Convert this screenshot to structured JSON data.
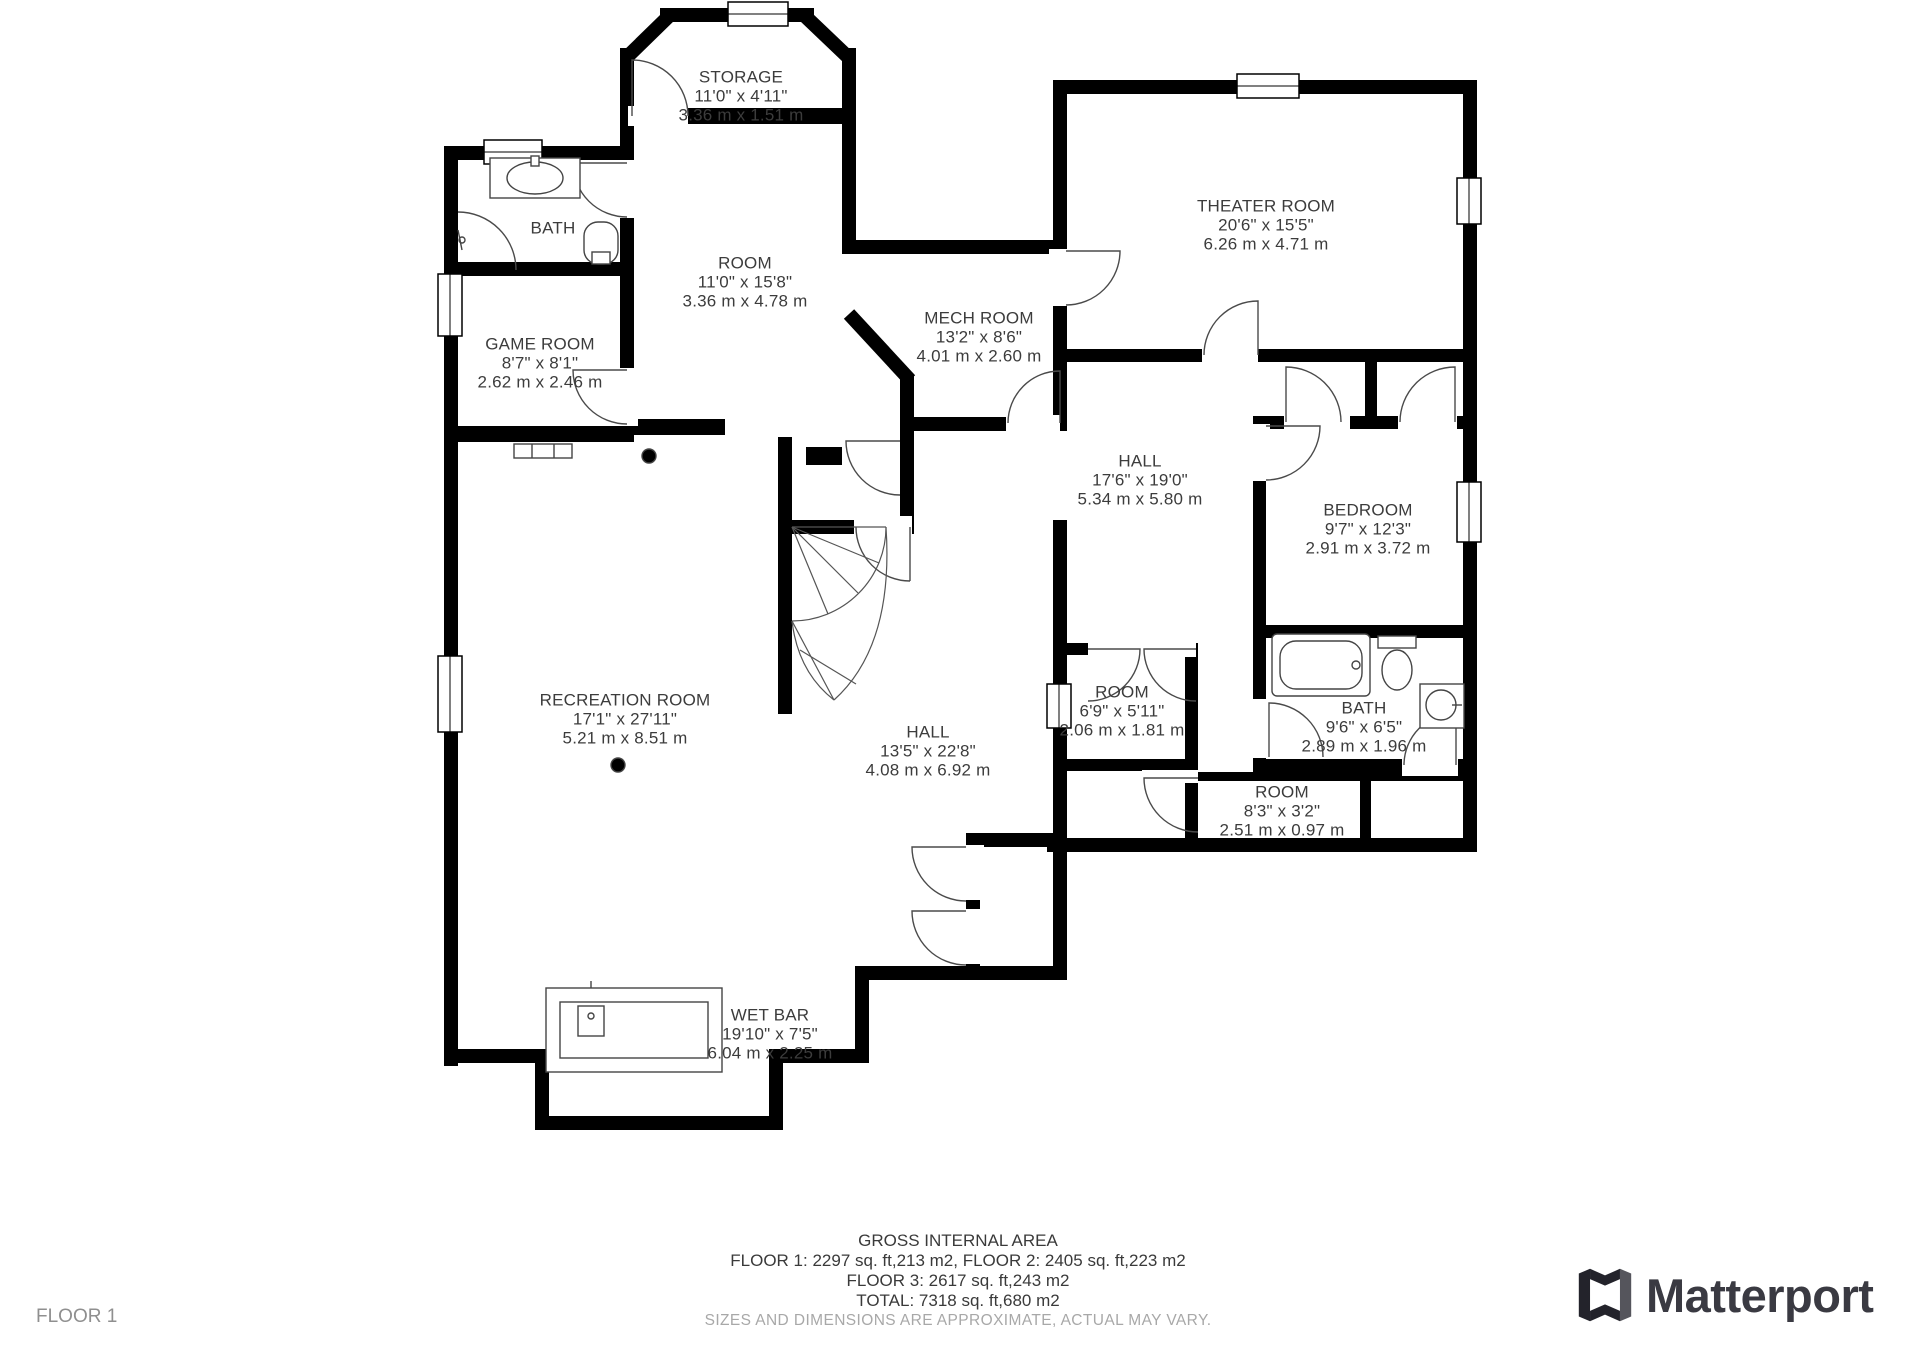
{
  "floor_indicator": "FLOOR 1",
  "brand": {
    "name": "Matterport"
  },
  "colors": {
    "wall": "#000000",
    "label_text": "#3c3c3c",
    "disclaimer_text": "#a8a8a8",
    "floor_indicator_text": "#8f8f8f",
    "logo_dark": "#23232b",
    "logo_gray": "#55555c"
  },
  "rooms": [
    {
      "id": "storage",
      "name": "STORAGE",
      "imperial": "11'0\" x 4'11\"",
      "metric": "3.36 m x 1.51 m"
    },
    {
      "id": "bath-1",
      "name": "BATH",
      "imperial": "",
      "metric": ""
    },
    {
      "id": "game-room",
      "name": "GAME ROOM",
      "imperial": "8'7\" x 8'1\"",
      "metric": "2.62 m x 2.46 m"
    },
    {
      "id": "room-top",
      "name": "ROOM",
      "imperial": "11'0\" x 15'8\"",
      "metric": "3.36 m x 4.78 m"
    },
    {
      "id": "mech-room",
      "name": "MECH ROOM",
      "imperial": "13'2\" x 8'6\"",
      "metric": "4.01 m x 2.60 m"
    },
    {
      "id": "theater",
      "name": "THEATER ROOM",
      "imperial": "20'6\" x 15'5\"",
      "metric": "6.26 m x 4.71 m"
    },
    {
      "id": "hall-1",
      "name": "HALL",
      "imperial": "17'6\" x 19'0\"",
      "metric": "5.34 m x 5.80 m"
    },
    {
      "id": "bedroom",
      "name": "BEDROOM",
      "imperial": "9'7\" x 12'3\"",
      "metric": "2.91 m x 3.72 m"
    },
    {
      "id": "recreation",
      "name": "RECREATION ROOM",
      "imperial": "17'1\" x 27'11\"",
      "metric": "5.21 m x 8.51 m"
    },
    {
      "id": "hall-2",
      "name": "HALL",
      "imperial": "13'5\" x 22'8\"",
      "metric": "4.08 m x 6.92 m"
    },
    {
      "id": "room-small",
      "name": "ROOM",
      "imperial": "6'9\" x 5'11\"",
      "metric": "2.06 m x 1.81 m"
    },
    {
      "id": "bath-2",
      "name": "BATH",
      "imperial": "9'6\" x 6'5\"",
      "metric": "2.89 m x 1.96 m"
    },
    {
      "id": "room-back",
      "name": "ROOM",
      "imperial": "8'3\" x 3'2\"",
      "metric": "2.51 m x 0.97 m"
    },
    {
      "id": "wet-bar",
      "name": "WET BAR",
      "imperial": "19'10\" x 7'5\"",
      "metric": "6.04 m x 2.25 m"
    }
  ],
  "footer": {
    "title": "GROSS INTERNAL AREA",
    "line1": "FLOOR 1: 2297 sq. ft,213 m2, FLOOR 2: 2405 sq. ft,223 m2",
    "line2": "FLOOR 3: 2617 sq. ft,243 m2",
    "line3": "TOTAL: 7318 sq. ft,680 m2",
    "disclaimer": "SIZES AND DIMENSIONS ARE APPROXIMATE, ACTUAL MAY VARY."
  }
}
